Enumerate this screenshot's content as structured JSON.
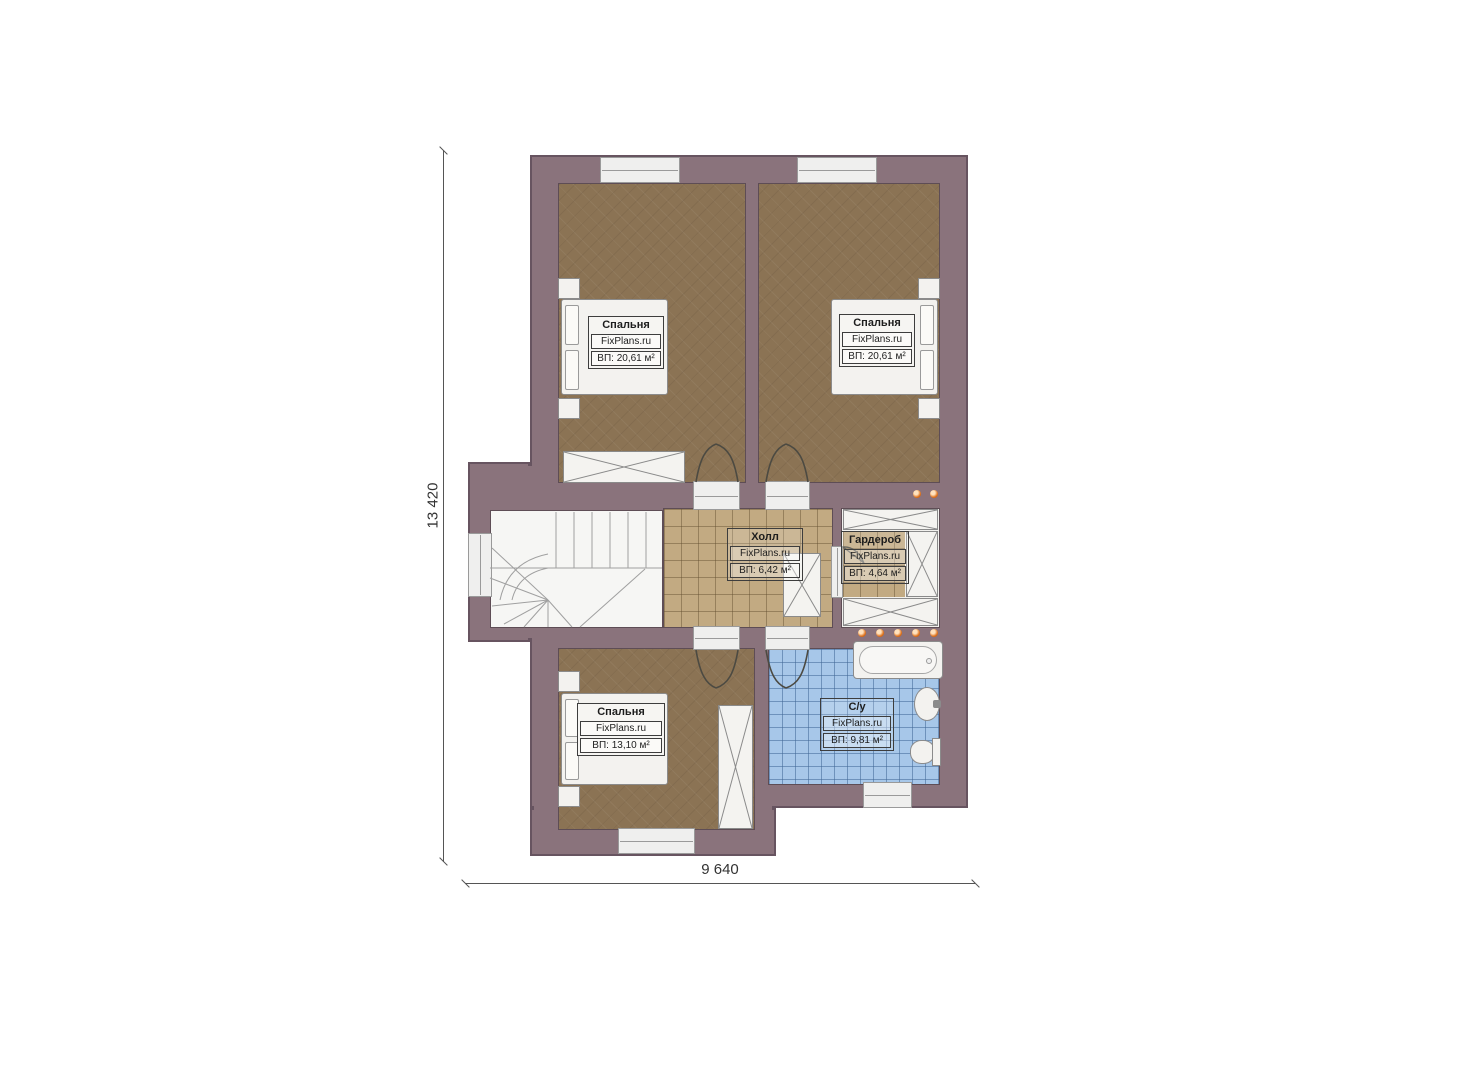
{
  "watermark": "FixPlans.ru",
  "rooms": [
    {
      "id": "bedroom-top-left",
      "name": "Спальня",
      "brand": "FixPlans.ru",
      "area": "ВП: 20,61 м²"
    },
    {
      "id": "bedroom-top-right",
      "name": "Спальня",
      "brand": "FixPlans.ru",
      "area": "ВП: 20,61 м²"
    },
    {
      "id": "hall",
      "name": "Холл",
      "brand": "FixPlans.ru",
      "area": "ВП: 6,42 м²"
    },
    {
      "id": "wardrobe",
      "name": "Гардероб",
      "brand": "FixPlans.ru",
      "area": "ВП: 4,64 м²"
    },
    {
      "id": "bedroom-bottom",
      "name": "Спальня",
      "brand": "FixPlans.ru",
      "area": "ВП: 13,10 м²"
    },
    {
      "id": "bathroom",
      "name": "С/у",
      "brand": "FixPlans.ru",
      "area": "ВП: 9,81 м²"
    }
  ],
  "dimensions": {
    "height": "13 420",
    "width": "9 640"
  },
  "colors": {
    "wall": "#8a737c",
    "bedroom_floor": "#8b7354",
    "hall_tile": "#c2aa82",
    "bath_tile": "#a7c7e9",
    "light_dot": "#e0751f",
    "dimension_text": "#333333"
  }
}
